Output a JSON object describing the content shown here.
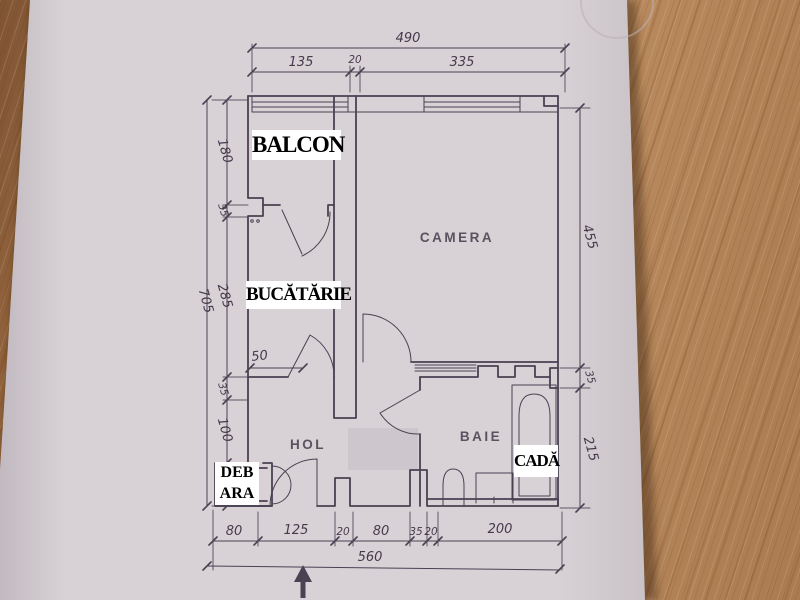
{
  "rooms": {
    "balcon": "BALCON",
    "bucatarie": "BUCĂTĂRIE",
    "camera": "CAMERA",
    "hol": "HOL",
    "baie": "BAIE",
    "cada": "CADĂ",
    "debara_line1": "DEB",
    "debara_line2": "ARA"
  },
  "dims": {
    "top": {
      "total": "490",
      "seg": [
        "135",
        "20",
        "335"
      ]
    },
    "left": {
      "total": "705",
      "seg": [
        "180",
        "35",
        "285",
        "35",
        "100",
        "70"
      ]
    },
    "right": {
      "seg": [
        "455",
        "35",
        "215"
      ]
    },
    "bottom": {
      "total": "560",
      "seg": [
        "80",
        "125",
        "20",
        "80",
        "35",
        "20",
        "200"
      ]
    },
    "kitchen_wall": "50"
  },
  "colors": {
    "ink": "#4a4152",
    "paper": "#d8d2d6",
    "wood": "#a9784e",
    "printed_label": "#59525f",
    "overlay_label_bg": "#ffffff"
  }
}
